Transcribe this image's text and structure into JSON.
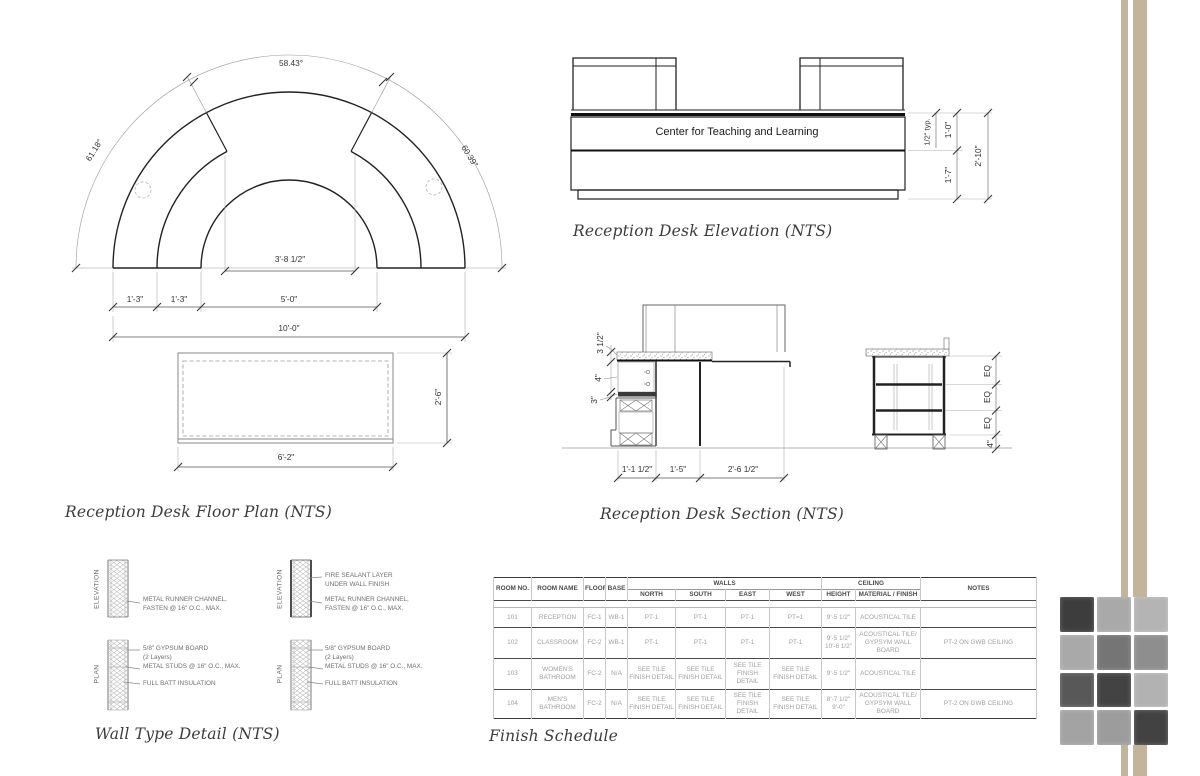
{
  "titles": {
    "floor_plan": "Reception Desk Floor Plan (NTS)",
    "elevation": "Reception Desk Elevation (NTS)",
    "section": "Reception Desk Section (NTS)",
    "wall_detail": "Wall Type Detail (NTS)",
    "finish_schedule": "Finish Schedule"
  },
  "floor_plan": {
    "angle_left": "61.18°",
    "angle_top": "58.43°",
    "angle_right": "60.39°",
    "dim_inner_width": "3'-8 1/2\"",
    "dim_seg1": "1'-3\"",
    "dim_seg2": "1'-3\"",
    "dim_seg3": "5'-0\"",
    "dim_overall": "10'-0\"",
    "counter_depth": "2'-6\"",
    "counter_width": "6'-2\""
  },
  "elevation": {
    "sign_text": "Center for Teaching and  Learning",
    "dim_top": "1/2\" typ.",
    "dim_sign": "1'-0\"",
    "dim_body": "1'-7\"",
    "dim_overall": "2'-10\""
  },
  "section": {
    "dim_counter": "3 1/2\"",
    "dim_shelf": "4\"",
    "dim_band": "3\"",
    "dim_cab": "1'-1 1/2\"",
    "dim_knee": "1'-5\"",
    "dim_front": "2'-6 1/2\"",
    "dim_eq1": "EQ",
    "dim_eq2": "EQ",
    "dim_eq3": "EQ",
    "dim_toe": "4\""
  },
  "wall_detail": {
    "label_elevation": "ELEVATION",
    "label_plan": "PLAN",
    "runner_note": "METAL RUNNER CHANNEL,\nFASTEN @ 16\" O.C., MAX.",
    "fire_note": "FIRE SEALANT LAYER\nUNDER WALL FINISH",
    "gypsum_note": "5/8\" GYPSUM BOARD\n(2 Layers)\nMETAL STUDS @ 16\" O.C., MAX.",
    "insulation_note": "FULL BATT INSULATION"
  },
  "schedule": {
    "headers": {
      "room_no": "ROOM NO.",
      "room_name": "ROOM NAME",
      "floor": "FLOOR",
      "base": "BASE",
      "walls": "WALLS",
      "north": "NORTH",
      "south": "SOUTH",
      "east": "EAST",
      "west": "WEST",
      "ceiling": "CEILING",
      "height": "HEIGHT",
      "material": "MATERIAL / FINISH",
      "notes": "NOTES"
    },
    "rows": [
      {
        "no": "101",
        "name": "RECEPTION",
        "floor": "FC-1",
        "base": "WB-1",
        "north": "PT-1",
        "south": "PT-1",
        "east": "PT-1",
        "west": "PT=1",
        "height": "9'-5 1/2\"",
        "material": "ACOUSTICAL TILE",
        "notes": ""
      },
      {
        "no": "102",
        "name": "CLASSROOM",
        "floor": "FC-2",
        "base": "WB-1",
        "north": "PT-1",
        "south": "PT-1",
        "east": "PT-1",
        "west": "PT-1",
        "height": "9'-5 1/2\"\n10'-6 1/2\"",
        "material": "ACOUSTICAL TILE/ GYPSYM WALL BOARD",
        "notes": "PT-2 ON GWB CEILING"
      },
      {
        "no": "103",
        "name": "WOMEN'S BATHROOM",
        "floor": "FC-2",
        "base": "N/A",
        "north": "SEE TILE FINISH DETAIL",
        "south": "SEE TILE FINISH DETAIL",
        "east": "SEE TILE FINISH DETAIL",
        "west": "SEE TILE FINISH DETAIL",
        "height": "9'-5 1/2\"",
        "material": "ACOUSTICAL TILE",
        "notes": ""
      },
      {
        "no": "104",
        "name": "MEN'S BATHROOM",
        "floor": "FC-2",
        "base": "N/A",
        "north": "SEE TILE FINISH DETAIL",
        "south": "SEE TILE FINISH DETAIL",
        "east": "SEE TILE FINISH DETAIL",
        "west": "SEE TILE FINISH DETAIL",
        "height": "8'-7 1/2\"\n9'-0\"",
        "material": "ACOUSTICAL TILE/ GYPSYM WALL BOARD",
        "notes": "PT-2 ON GWB CEILING"
      }
    ]
  },
  "decor": {
    "stripe_color": "#c3b59b",
    "tile_colors": [
      "#3d3d3d",
      "#a9a9a9",
      "#b4b4b4",
      "#a9a9a9",
      "#757575",
      "#8e8e8e",
      "#585858",
      "#434343",
      "#b2b2b2",
      "#a3a3a3",
      "#9c9c9c",
      "#424242"
    ]
  }
}
